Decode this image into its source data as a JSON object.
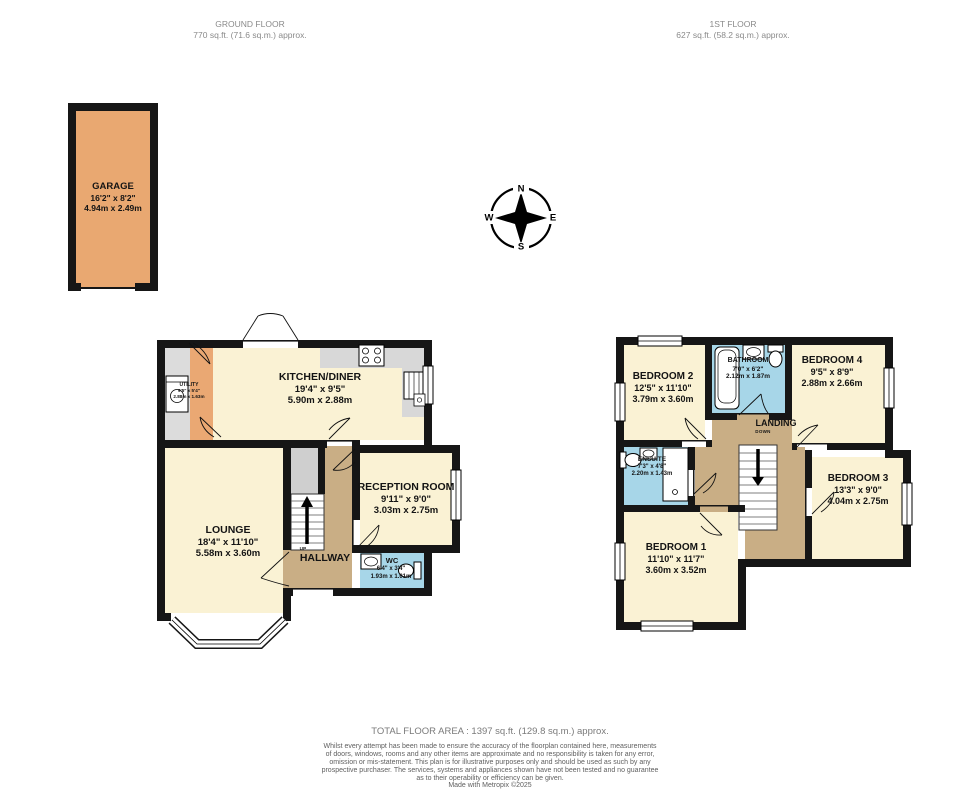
{
  "headers": {
    "ground": {
      "title": "GROUND FLOOR",
      "area": "770 sq.ft. (71.6 sq.m.) approx."
    },
    "first": {
      "title": "1ST FLOOR",
      "area": "627 sq.ft. (58.2 sq.m.) approx."
    }
  },
  "compass": {
    "north": "N",
    "east": "E",
    "south": "S",
    "west": "W"
  },
  "ground_floor": {
    "garage": {
      "name": "GARAGE",
      "size_imperial": "16'2\" x 8'2\"",
      "size_metric": "4.94m x 2.49m"
    },
    "utility": {
      "name": "UTILITY",
      "size_imperial": "9'5\" x 5'4\"",
      "size_metric": "2.88m x 1.63m"
    },
    "kitchen_diner": {
      "name": "KITCHEN/DINER",
      "size_imperial": "19'4\" x 9'5\"",
      "size_metric": "5.90m x 2.88m"
    },
    "reception_room": {
      "name": "RECEPTION ROOM",
      "size_imperial": "9'11\" x 9'0\"",
      "size_metric": "3.03m x 2.75m"
    },
    "lounge": {
      "name": "LOUNGE",
      "size_imperial": "18'4\" x 11'10\"",
      "size_metric": "5.58m x 3.60m"
    },
    "hallway": {
      "name": "HALLWAY",
      "stairs_label": "UP"
    },
    "wc": {
      "name": "WC",
      "size_imperial": "6'4\" x 3'4\"",
      "size_metric": "1.93m x 1.01m"
    }
  },
  "first_floor": {
    "bedroom_2": {
      "name": "BEDROOM 2",
      "size_imperial": "12'5\" x 11'10\"",
      "size_metric": "3.79m x 3.60m"
    },
    "bathroom": {
      "name": "BATHROOM",
      "size_imperial": "7'0\" x 6'2\"",
      "size_metric": "2.12m x 1.87m"
    },
    "bedroom_4": {
      "name": "BEDROOM 4",
      "size_imperial": "9'5\" x 8'9\"",
      "size_metric": "2.88m x 2.66m"
    },
    "landing": {
      "name": "LANDING",
      "stairs_label": "DOWN"
    },
    "ensuite": {
      "name": "ENSUITE",
      "size_imperial": "7'3\" x 4'8\"",
      "size_metric": "2.20m x 1.43m"
    },
    "bedroom_1": {
      "name": "BEDROOM 1",
      "size_imperial": "11'10\" x 11'7\"",
      "size_metric": "3.60m x 3.52m"
    },
    "bedroom_3": {
      "name": "BEDROOM 3",
      "size_imperial": "13'3\" x 9'0\"",
      "size_metric": "4.04m x 2.75m"
    }
  },
  "footer": {
    "total_area": "TOTAL FLOOR AREA : 1397 sq.ft. (129.8 sq.m.) approx.",
    "disclaimer": [
      "Whilst every attempt has been made to ensure the accuracy of the floorplan contained here, measurements",
      "of doors, windows, rooms and any other items are approximate and no responsibility is taken for any error,",
      "omission or mis-statement. This plan is for illustrative purposes only and should be used as such by any",
      "prospective purchaser. The services, systems and appliances shown have not been tested and no guarantee",
      "as to their operability or efficiency can be given."
    ],
    "credit": "Made with Metropix ©2025"
  },
  "colors": {
    "wall": "#161616",
    "room_cream": "#faf2d4",
    "garage_orange": "#e9a871",
    "hall_tan": "#c9ae85",
    "wet_room_blue": "#a7d6e8",
    "counter_grey": "#d8d8d8",
    "header_grey": "#8a8a8a"
  }
}
